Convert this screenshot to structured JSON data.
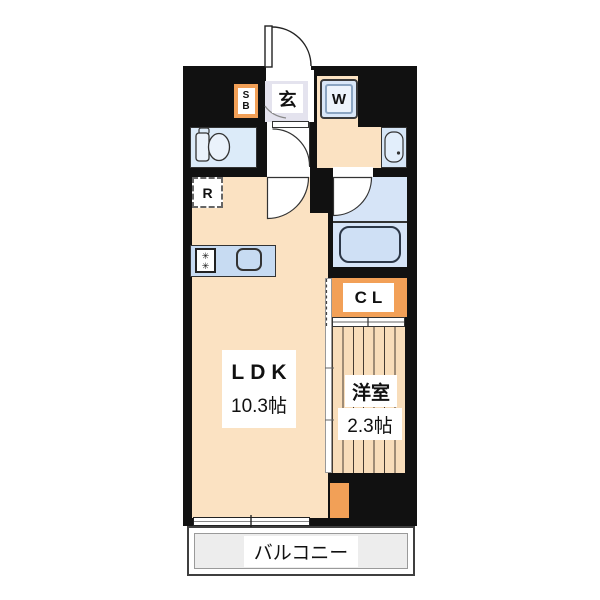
{
  "floor_plan": {
    "rooms": {
      "genkan": {
        "label": "玄"
      },
      "shoe_box": {
        "line1": "S",
        "line2": "B"
      },
      "washing_machine": {
        "label": "W"
      },
      "refrigerator": {
        "label": "R"
      },
      "closet": {
        "label": "CL"
      },
      "ldk": {
        "name": "LDK",
        "size": "10.3帖"
      },
      "western_room": {
        "name": "洋室",
        "size": "2.3帖"
      },
      "balcony": {
        "label": "バルコニー"
      }
    },
    "icons": {
      "burner_glyph": "✳"
    },
    "colors": {
      "wall": "#111111",
      "floor_cream": "#fbe2c2",
      "accent_orange": "#f2a057",
      "genkan_lavender": "#e4e3ee",
      "wet_area_blue": "#d6e6f7",
      "toilet_blue": "#dcebf9",
      "kitchen_blue": "#c7dbf2",
      "tub_blue": "#cfe0f5",
      "western_room_tatami": "#f8ddba",
      "balcony_gray": "#ededed"
    }
  }
}
